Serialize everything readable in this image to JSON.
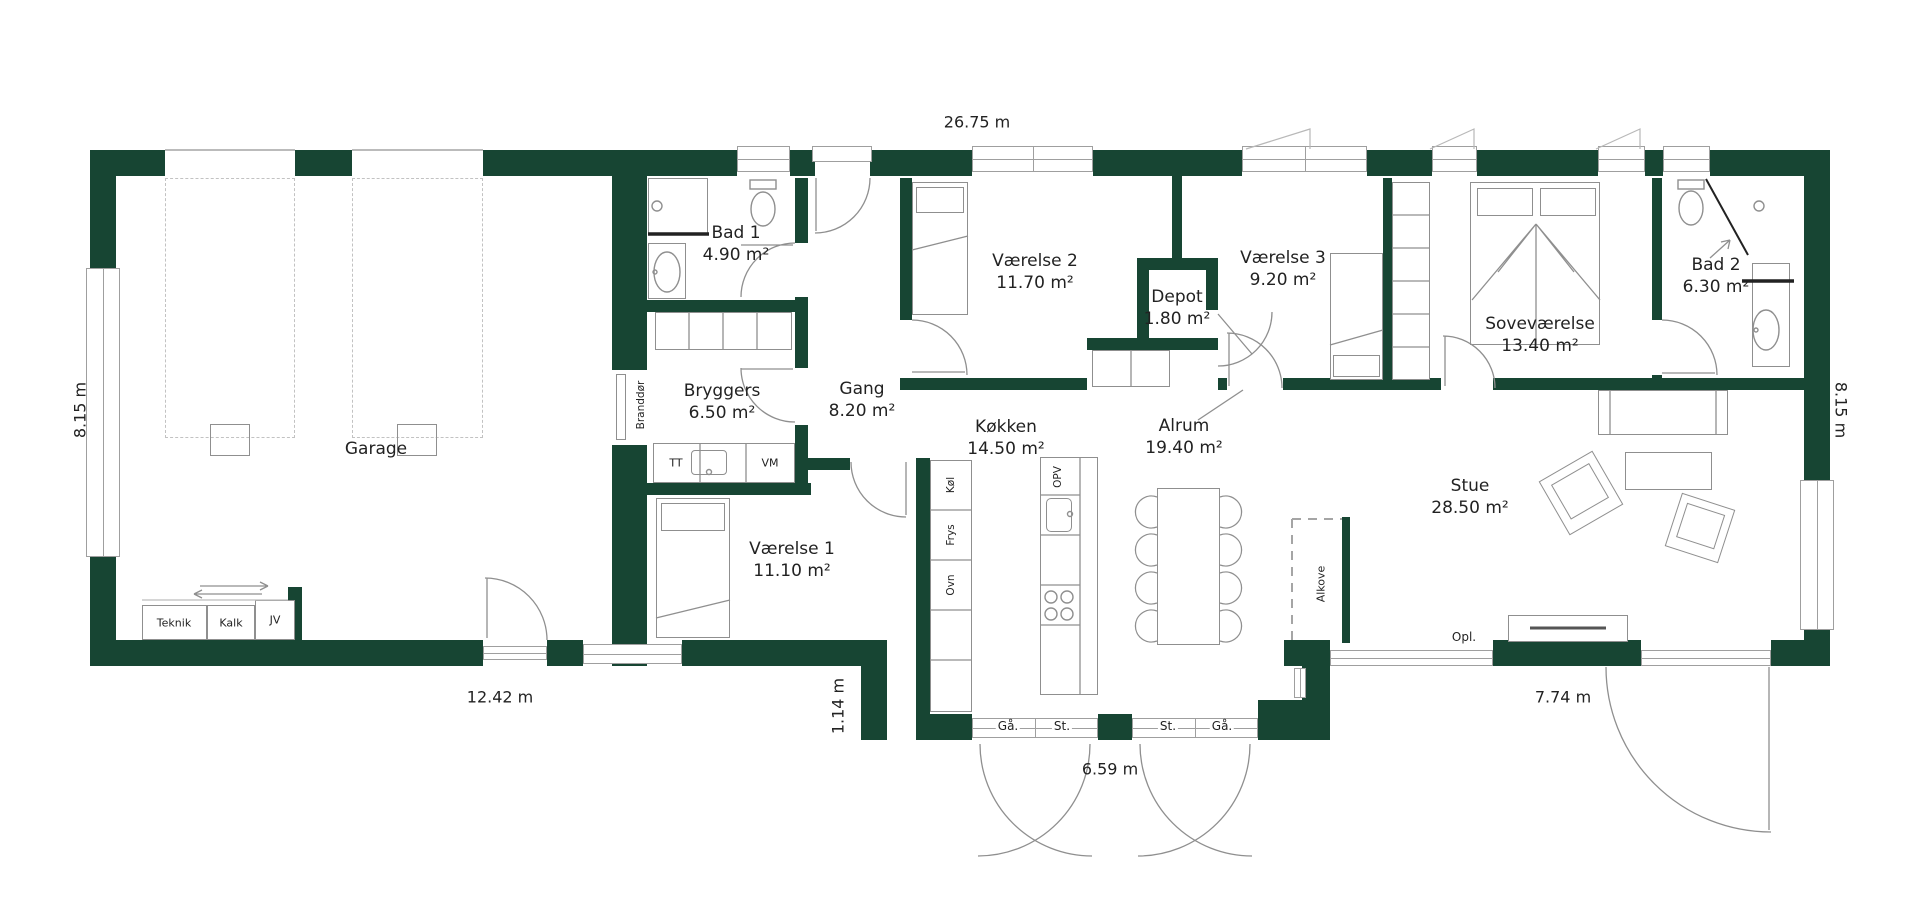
{
  "colors": {
    "wall": "#174533",
    "line": "#8f8f8f",
    "line2": "#9f9f9f",
    "dash": "#c2c2c2",
    "text": "#222222"
  },
  "rooms": [
    {
      "id": "garage",
      "name": "Garage",
      "area": ""
    },
    {
      "id": "bad1",
      "name": "Bad 1",
      "area": "4.90 m²"
    },
    {
      "id": "bryggers",
      "name": "Bryggers",
      "area": "6.50 m²"
    },
    {
      "id": "gang",
      "name": "Gang",
      "area": "8.20 m²"
    },
    {
      "id": "vaerelse1",
      "name": "Værelse 1",
      "area": "11.10 m²"
    },
    {
      "id": "vaerelse2",
      "name": "Værelse 2",
      "area": "11.70 m²"
    },
    {
      "id": "depot",
      "name": "Depot",
      "area": "1.80 m²"
    },
    {
      "id": "vaerelse3",
      "name": "Værelse 3",
      "area": "9.20 m²"
    },
    {
      "id": "koekken",
      "name": "Køkken",
      "area": "14.50 m²"
    },
    {
      "id": "alrum",
      "name": "Alrum",
      "area": "19.40 m²"
    },
    {
      "id": "sovevaerelse",
      "name": "Soveværelse",
      "area": "13.40 m²"
    },
    {
      "id": "bad2",
      "name": "Bad 2",
      "area": "6.30 m²"
    },
    {
      "id": "stue",
      "name": "Stue",
      "area": "28.50 m²"
    }
  ],
  "dimensions": {
    "top": "26.75 m",
    "left": "8.15 m",
    "right": "8.15 m",
    "garage_bottom": "12.42 m",
    "recess": "1.14 m",
    "terrace_doors": "6.59 m",
    "stue_bottom": "7.74 m"
  },
  "fixtures": {
    "branddoer": "Branddør",
    "teknik": "Teknik",
    "kalk": "Kalk",
    "jv": "JV",
    "tt": "TT",
    "vm": "VM",
    "koel": "Køl",
    "frys": "Frys",
    "ovn": "Ovn",
    "opv": "OPV",
    "alkove": "Alkove",
    "opl": "Opl."
  },
  "door_labels": {
    "gaa": "Gå.",
    "st": "St."
  }
}
